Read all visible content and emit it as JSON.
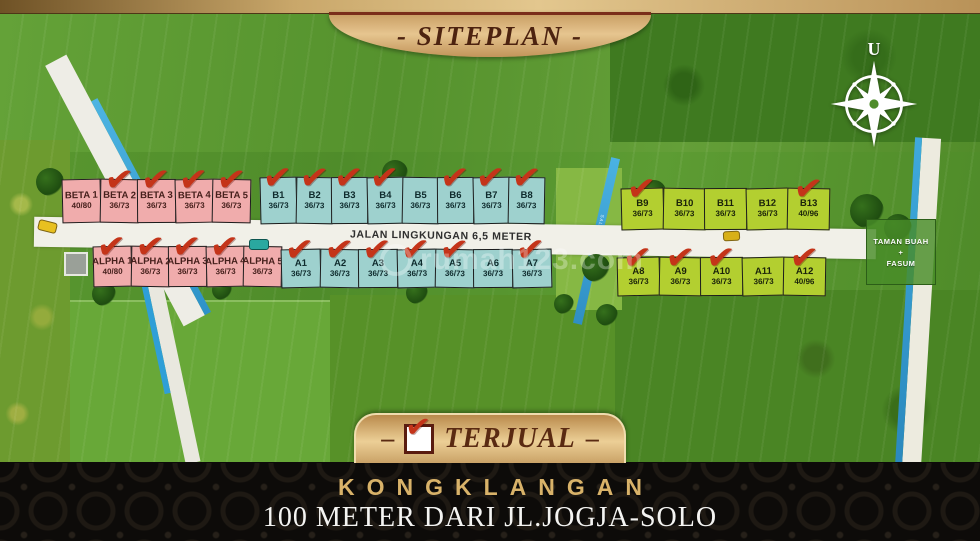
{
  "banner": {
    "title": "- SITEPLAN -"
  },
  "compass": {
    "north": "U"
  },
  "road": {
    "label": "JALAN LINGKUNGAN 6,5 METER"
  },
  "channel": {
    "label": "SALURAN IRIGASI"
  },
  "facility": {
    "line1": "TAMAN BUAH",
    "line2": "+",
    "line3": "FASUM"
  },
  "watermark": {
    "text": "rumah123.com"
  },
  "legend": {
    "dash_left": "–",
    "label": "TERJUAL",
    "dash_right": "–"
  },
  "footer": {
    "name": "KONGKLANGAN",
    "subtitle": "100 METER DARI JL.JOGJA-SOLO"
  },
  "icons": {
    "sold_check": "✔",
    "north_arrow": "compass-rose"
  },
  "colors": {
    "pink": "#f0acac",
    "blue": "#9ed1ce",
    "green": "#b3cf30",
    "check_red": "#c43419",
    "gold": "#d8b269"
  },
  "plot_rows": [
    {
      "id": "beta",
      "palette": "pink",
      "plots": [
        {
          "name": "BETA 1",
          "size": "40/80",
          "sold": false
        },
        {
          "name": "BETA 2",
          "size": "36/73",
          "sold": true
        },
        {
          "name": "BETA 3",
          "size": "36/73",
          "sold": true
        },
        {
          "name": "BETA 4",
          "size": "36/73",
          "sold": true
        },
        {
          "name": "BETA 5",
          "size": "36/73",
          "sold": true
        }
      ]
    },
    {
      "id": "b-blue",
      "palette": "blue",
      "plots": [
        {
          "name": "B1",
          "size": "36/73",
          "sold": true
        },
        {
          "name": "B2",
          "size": "36/73",
          "sold": true
        },
        {
          "name": "B3",
          "size": "36/73",
          "sold": true
        },
        {
          "name": "B4",
          "size": "36/73",
          "sold": true
        },
        {
          "name": "B5",
          "size": "36/73",
          "sold": false
        },
        {
          "name": "B6",
          "size": "36/73",
          "sold": true
        },
        {
          "name": "B7",
          "size": "36/73",
          "sold": true
        },
        {
          "name": "B8",
          "size": "36/73",
          "sold": true
        }
      ]
    },
    {
      "id": "b-green",
      "palette": "green",
      "plots": [
        {
          "name": "B9",
          "size": "36/73",
          "sold": true
        },
        {
          "name": "B10",
          "size": "36/73",
          "sold": false
        },
        {
          "name": "B11",
          "size": "36/73",
          "sold": false
        },
        {
          "name": "B12",
          "size": "36/73",
          "sold": false
        },
        {
          "name": "B13",
          "size": "40/96",
          "sold": true
        }
      ]
    },
    {
      "id": "alpha",
      "palette": "pink",
      "plots": [
        {
          "name": "ALPHA 1",
          "size": "40/80",
          "sold": true
        },
        {
          "name": "ALPHA 2",
          "size": "36/73",
          "sold": true
        },
        {
          "name": "ALPHA 3",
          "size": "36/73",
          "sold": true
        },
        {
          "name": "ALPHA 4",
          "size": "36/73",
          "sold": true
        },
        {
          "name": "ALPHA 5",
          "size": "36/73",
          "sold": false
        }
      ]
    },
    {
      "id": "a-blue",
      "palette": "blue",
      "plots": [
        {
          "name": "A1",
          "size": "36/73",
          "sold": true
        },
        {
          "name": "A2",
          "size": "36/73",
          "sold": true
        },
        {
          "name": "A3",
          "size": "36/73",
          "sold": true
        },
        {
          "name": "A4",
          "size": "36/73",
          "sold": true
        },
        {
          "name": "A5",
          "size": "36/73",
          "sold": true
        },
        {
          "name": "A6",
          "size": "36/73",
          "sold": false
        },
        {
          "name": "A7",
          "size": "36/73",
          "sold": true
        }
      ]
    },
    {
      "id": "a-green",
      "palette": "green",
      "plots": [
        {
          "name": "A8",
          "size": "36/73",
          "sold": true
        },
        {
          "name": "A9",
          "size": "36/73",
          "sold": true
        },
        {
          "name": "A10",
          "size": "36/73",
          "sold": true
        },
        {
          "name": "A11",
          "size": "36/73",
          "sold": false
        },
        {
          "name": "A12",
          "size": "40/96",
          "sold": true
        }
      ]
    }
  ]
}
